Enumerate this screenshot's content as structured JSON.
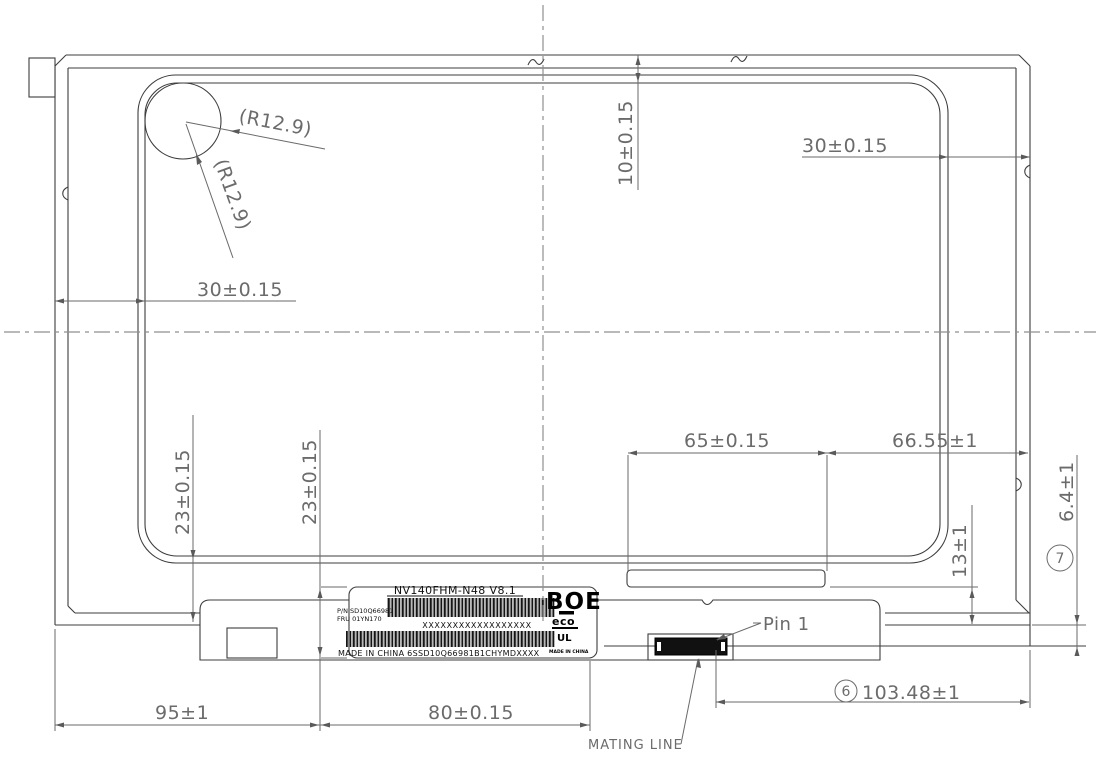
{
  "colors": {
    "line": "#3d3d3d",
    "dimension": "#6b6b6b",
    "centerline": "#8f8f8f",
    "background": "#ffffff",
    "label_ink": "#111111"
  },
  "dims": {
    "radius_1": "(R12.9)",
    "radius_2": "(R12.9)",
    "top_edge": "10±0.15",
    "top_right": "30±0.15",
    "left": "30±0.15",
    "active_bottom_1": "23±0.15",
    "active_bottom_2": "23±0.15",
    "slot": "65±0.15",
    "slot_to_edge": "66.55±1",
    "shelf": "13±1",
    "mating_offset": "6.4±1",
    "note7": "7",
    "note6": "6",
    "pin1": "Pin 1",
    "pin_to_edge": "103.48±1",
    "mating_line": "MATING LINE",
    "bottom_left": "95±1",
    "bottom_mid": "80±0.15"
  },
  "label": {
    "model": "NV140FHM-N48 V8.1",
    "pn": "P/N SD10Q66981",
    "fru": "FRU 01YN170",
    "serial": "XXXXXXXXXXXXXXXXXX",
    "origin": "MADE IN CHINA 6SSD10Q66981B1CHYMDXXXX",
    "brand": "BOE",
    "eco": "eco",
    "ul": "UL",
    "origin_small": "MADE IN CHINA"
  }
}
